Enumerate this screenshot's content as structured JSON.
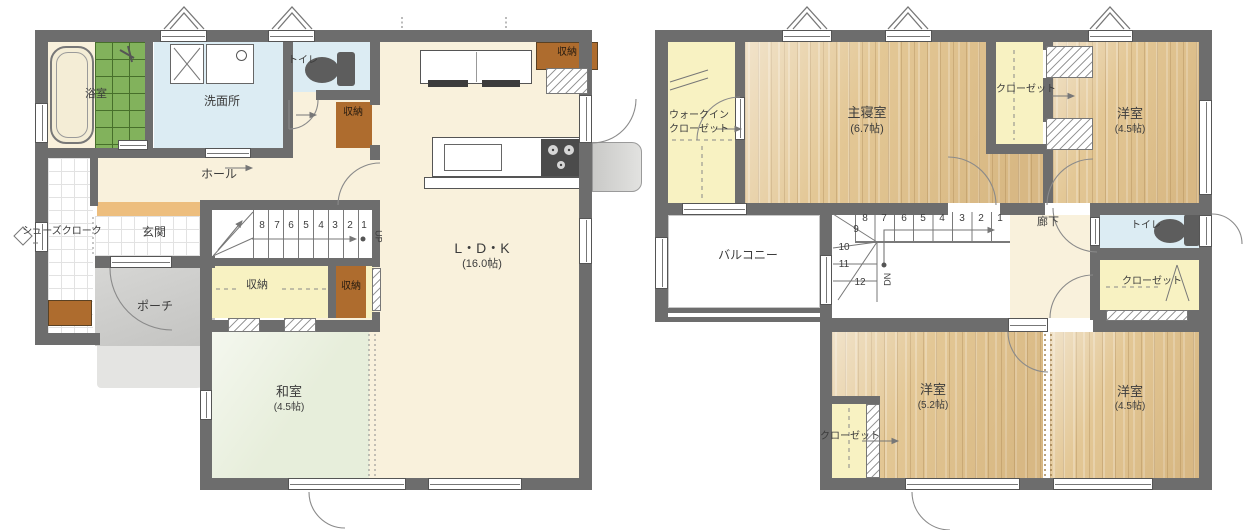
{
  "palette": {
    "wall": "#6d6d6d",
    "wood_floor": "#e3c795",
    "tatami": "#e7eedb",
    "water_rooms": "#dcecf3",
    "closet_yellow": "#f8f2c2",
    "floor_cream": "#f9f1dc",
    "storage_brown": "#ae6c2e",
    "bath_tile_green": "#82b25c",
    "entry_step": "#edbe7e"
  },
  "floor1": {
    "bathroom": "浴室",
    "washroom": "洗面所",
    "toilet": "トイレ",
    "storage_a": "収納",
    "storage_b": "収納",
    "storage_c": "収納",
    "storage_d": "収納",
    "hall": "ホール",
    "shoes_closet": "シューズクローク",
    "entrance": "玄関",
    "porch": "ポーチ",
    "ldk": {
      "name": "L・D・K",
      "size": "(16.0帖)"
    },
    "washitsu": {
      "name": "和室",
      "size": "(4.5帖)"
    },
    "stairs": {
      "numbers": [
        "8",
        "7",
        "6",
        "5",
        "4",
        "3",
        "2",
        "1"
      ],
      "direction": "UP"
    }
  },
  "floor2": {
    "wic": {
      "line1": "ウォークイン",
      "line2": "クローゼット"
    },
    "master": {
      "name": "主寝室",
      "size": "(6.7帖)"
    },
    "closet_top": "クローゼット",
    "room_ne": {
      "name": "洋室",
      "size": "(4.5帖)"
    },
    "balcony": "バルコニー",
    "hallway": "廊下",
    "toilet": "トイレ",
    "closet_east": "クローゼット",
    "room_sw": {
      "name": "洋室",
      "size": "(5.2帖)"
    },
    "closet_sw": "クローゼット",
    "room_se": {
      "name": "洋室",
      "size": "(4.5帖)"
    },
    "stairs": {
      "numbers_run": [
        "8",
        "7",
        "6",
        "5",
        "4",
        "3",
        "2",
        "1"
      ],
      "numbers_winder": [
        "9",
        "10",
        "11",
        "12"
      ],
      "direction": "DN"
    }
  }
}
